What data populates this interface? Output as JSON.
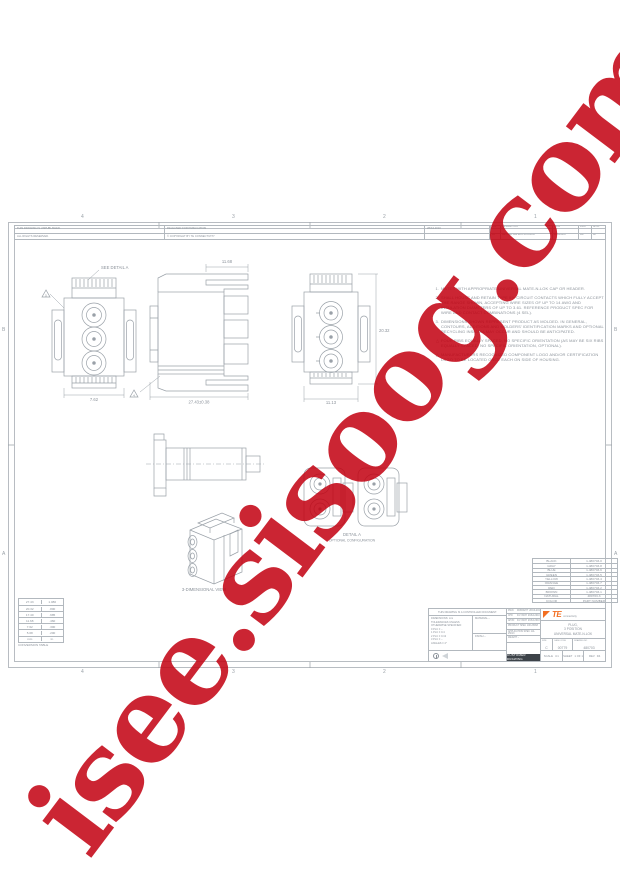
{
  "watermark": {
    "text": "isee.sisoog.com",
    "color": "#c30010"
  },
  "zones": {
    "cols": [
      "4",
      "3",
      "2",
      "1"
    ],
    "rows": [
      "B",
      "A"
    ]
  },
  "rev_strip": {
    "rows": [
      [
        "THIS DRAWING IS UNPUBLISHED.",
        "RELEASED FOR PUBLICATION",
        "28JUL2010"
      ],
      [
        "ALL RIGHTS RESERVED.",
        "© COPYRIGHT BY TE CONNECTIVITY",
        ""
      ]
    ]
  },
  "revisions": {
    "header": [
      "LTR",
      "DESCRIPTION",
      "DATE",
      "DWN",
      "APVD"
    ],
    "row": [
      "D4",
      "REVISED PER ECO-10-012345",
      "28JUL2010",
      "MB",
      "DL"
    ]
  },
  "notes": {
    "items": [
      {
        "marker": "1.",
        "text": "MATES WITH APPROPRIATE UNIVERSAL MATE-N-LOK CAP OR HEADER."
      },
      {
        "marker": "2.",
        "text": "SHALL HOUSE AND RETAIN TYPE III+ CIRCUIT CONTACTS WHICH FULLY ACCEPT THE RANGE SHOWN, ACCEPTING WIRE SIZES OF UP TO 14 AWG AND INSULATION DIAMETERS OF UP TO 3.61. REFERENCE PRODUCT SPEC FOR WIRE AND CONTACT COMBINATIONS (4 SEL)."
      },
      {
        "marker": "3.",
        "text": "DIMENSIONS SHOWN REPRESENT PRODUCT AS MOLDED. IN GENERAL, CONTOURS, ADDITIONS AND MOLDERS' IDENTIFICATION MARKS AND OPTIONAL RECYCLING INSIGNIA MAY OCCUR AND SHOULD BE ANTICIPATED."
      },
      {
        "marker": "△",
        "text": "FOUR RIBS EQUALLY SPACED, NO SPECIFIC ORIENTATION (AS MAY BE SIX RIBS EQUALLY SPACED, NO SPECIFIC ORIENTATION, OPTIONAL)."
      },
      {
        "marker": "△",
        "text": "MANUFACTURERS RECOGNIZED COMPONENT LOGO AND/OR CERTIFICATION LOGO TO BE LOCATED ONCE EACH ON SIDE OF HOUSING."
      }
    ]
  },
  "views": {
    "see_detail": "SEE DETAIL A",
    "front_width": "7.62",
    "side_depth": "11.68",
    "side_length": "27.43±0.38",
    "rear_height": "20.32",
    "rear_width": "11.13",
    "flag_front": "5",
    "flag_side": "4",
    "detail_caption": "DETAIL A",
    "detail_sub": "OPTIONAL CONFIGURATION",
    "iso_caption": "3-DIMENSIONAL VIEW"
  },
  "parts_table": {
    "rows": [
      {
        "color": "BLACK",
        "part": "1-480703-0"
      },
      {
        "color": "GRAY",
        "part": "1-480703-8"
      },
      {
        "color": "BLUE",
        "part": "1-480703-6"
      },
      {
        "color": "GREEN",
        "part": "1-480703-5"
      },
      {
        "color": "YELLOW",
        "part": "1-480703-4"
      },
      {
        "color": "ORANGE",
        "part": "1-480703-7"
      },
      {
        "color": "RED",
        "part": "1-480703-2"
      },
      {
        "color": "BROWN",
        "part": "1-480703-1"
      },
      {
        "color": "NATURAL",
        "part": "480703-3"
      }
    ],
    "footer": {
      "color": "COLOR",
      "part": "PART NUMBER"
    }
  },
  "conversion_table": {
    "rows": [
      [
        "27.43",
        "1.080"
      ],
      [
        "20.32",
        ".800"
      ],
      [
        "17.40",
        ".685"
      ],
      [
        "11.68",
        ".460"
      ],
      [
        "7.62",
        ".300"
      ],
      [
        "5.08",
        ".200"
      ]
    ],
    "footer": [
      "mm",
      "in."
    ],
    "caption": "CONVERSION TABLE"
  },
  "title_block": {
    "controlled": "THIS DRAWING IS A CONTROLLED DOCUMENT.",
    "dimensions_label": "DIMENSIONS:",
    "units": "mm",
    "tolerances": [
      "TOLERANCES UNLESS",
      "OTHERWISE SPECIFIED:",
      "0 PLC  ± –",
      "1 PLC  ± 0.4",
      "2 PLC  ± 0.13",
      "3 PLC  ± –",
      "ANGLES ± 4°"
    ],
    "material_label": "MATERIAL",
    "material": "–",
    "finish_label": "FINISH",
    "finish": "–",
    "signoff": [
      {
        "role": "DWN",
        "name": "M.BRIGHT",
        "date": "28JUL2010"
      },
      {
        "role": "CHK",
        "name": "D.LYNCH",
        "date": "28JUL2010"
      },
      {
        "role": "APVD",
        "name": "D.LYNCH",
        "date": "28JUL2010"
      }
    ],
    "specs": [
      {
        "label": "PRODUCT SPEC",
        "value": "108-25068"
      },
      {
        "label": "APPLICATION SPEC",
        "value": "114-25013"
      },
      {
        "label": "WEIGHT",
        "value": "–"
      }
    ],
    "customer_drawing": "CUSTOMER DRAWING",
    "logo": "TE",
    "logo_sub": "connectivity",
    "title_lines": [
      "PLUG,",
      "3 POSITION",
      "UNIVERSAL MATE-N-LOK"
    ],
    "size_label": "SIZE",
    "size": "C",
    "cage_label": "CAGE CODE",
    "cage": "00779",
    "dwg_label": "DRAWING NO",
    "dwg": "480703",
    "scale_label": "SCALE",
    "scale": "4:1",
    "sheet_label": "SHEET",
    "sheet": "1 OF 1",
    "rev_label": "REV",
    "rev": "D4"
  }
}
